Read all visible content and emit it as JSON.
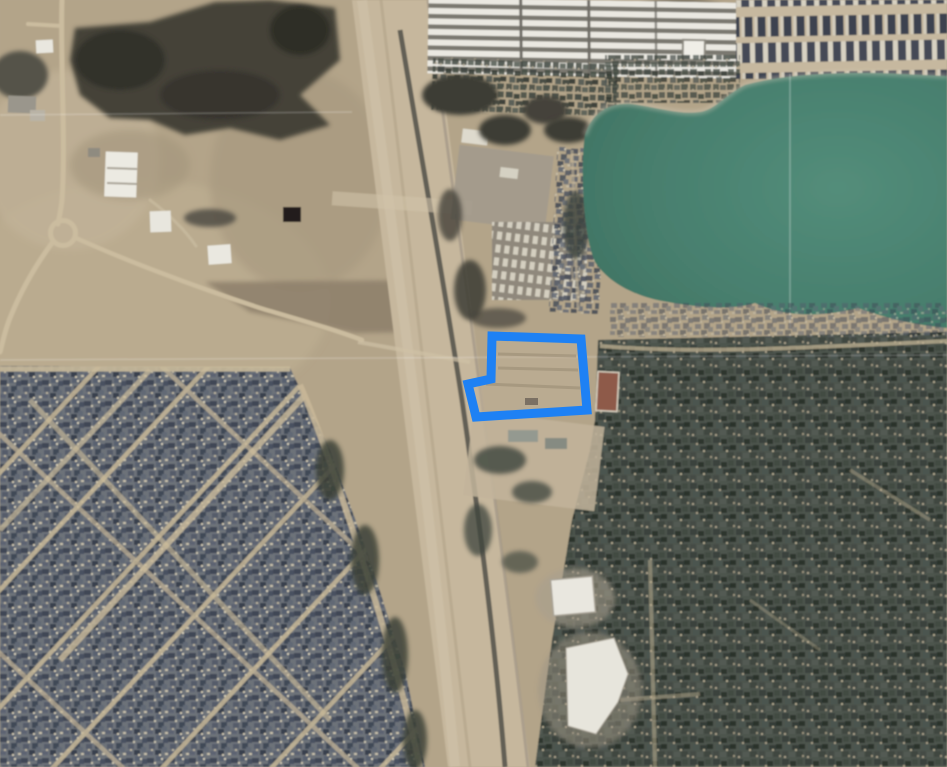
{
  "app": {
    "name": "aerial-map-view",
    "description": "Satellite aerial imagery with a highlighted property parcel outline"
  },
  "map": {
    "parcel": {
      "points": "492,336 581,339 587,410 476,417 468,384 491,379",
      "stroke_color": "#1e81f4",
      "stroke_width": "9",
      "fill_color": "#c3b49b",
      "fill_opacity": "0.45"
    },
    "lake": {
      "path": "M585,135 C592,112 610,102 632,104 C655,107 680,115 700,112 C715,110 725,95 745,85 C780,75 830,72 880,73 L947,76 L947,328 C915,325 885,318 858,308 C830,315 790,320 755,303 C735,310 700,308 668,302 C640,298 610,285 595,262 C583,235 580,165 585,135 Z",
      "boundary_line": {
        "x1": "790",
        "y1": "74",
        "x2": "790",
        "y2": "329"
      }
    },
    "highway": {
      "band_points": "352,0 432,0 530,767 448,767",
      "road_path": "M400,30 C420,150 445,290 462,400 C478,510 495,640 505,767",
      "edge_path": "M362,0 C395,250 430,500 455,767"
    },
    "regions": {
      "neighborhood_sw": {
        "points": "0,366 290,368 330,450 370,560 405,670 425,767 0,767"
      },
      "wooded_se": {
        "points": "598,340 947,332 947,767 535,767 552,640 572,520 590,450 595,420"
      },
      "storage_facility": {
        "x": "428",
        "y": "0",
        "width": "310",
        "height": "76"
      },
      "houses_ne": {
        "x": "736",
        "y": "0",
        "width": "211",
        "height": "79"
      }
    },
    "grid_lines": {
      "h_left": {
        "x1": "0",
        "y1": "115",
        "x2": "352",
        "y2": "112"
      },
      "h_full": {
        "x1": "0",
        "y1": "360",
        "x2": "947",
        "y2": "355"
      }
    },
    "palette": {
      "land": "#b3a489",
      "land_light": "#c8b99e",
      "land_dark": "#9a8c74",
      "dirt_field": "#8d7f6a",
      "lake_center": "#538d7a",
      "lake_edge": "#477e6d",
      "highway_band": "#c6b79d",
      "road_dark": "#56544e",
      "street_tan": "#c8b898",
      "roofs_base": "#6b7079",
      "wood_base": "#4e544d",
      "trees": "#454239",
      "white_building": "#eceae2",
      "red_building": "#8e5a49",
      "grid_line": "#ffffff"
    }
  }
}
